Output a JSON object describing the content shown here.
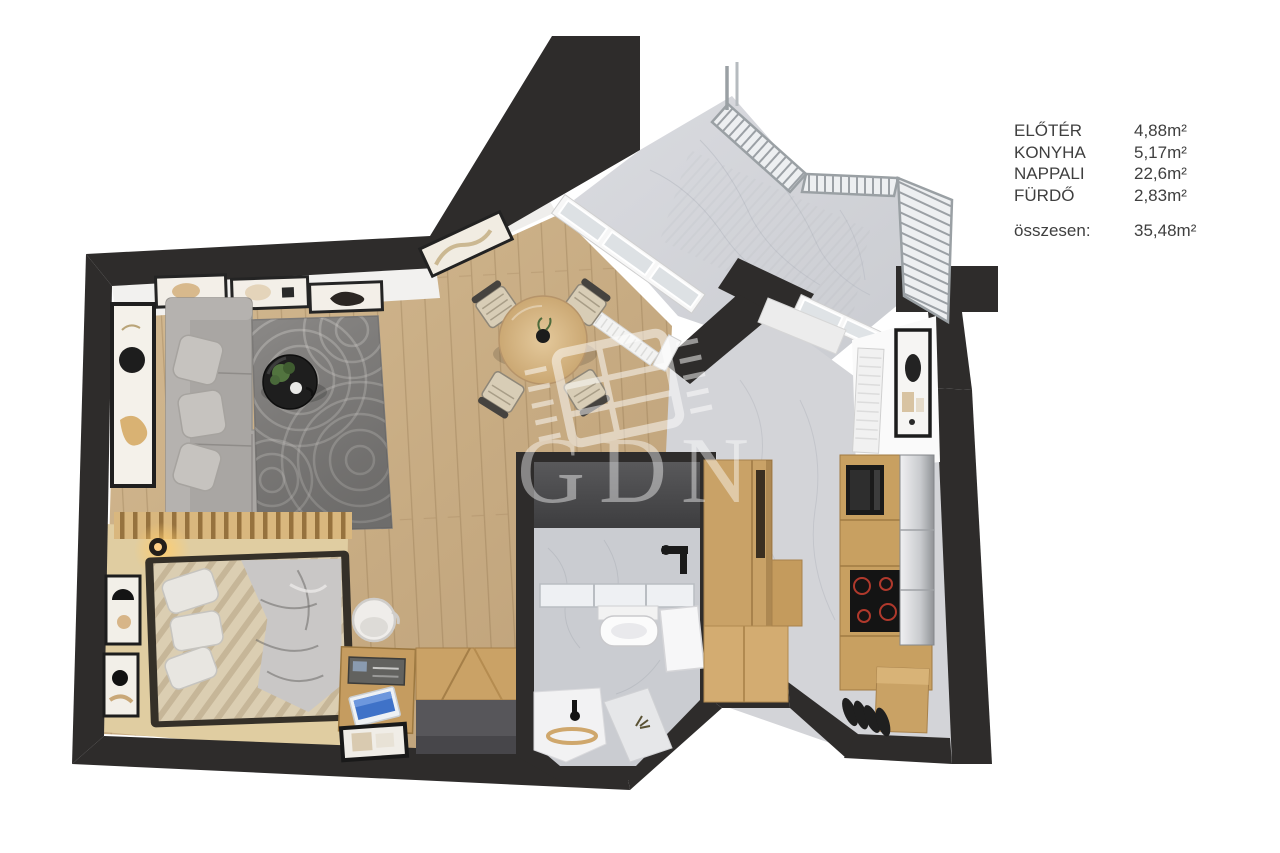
{
  "legend": {
    "rows": [
      {
        "label": "ELŐTÉR",
        "value": "4,88m²"
      },
      {
        "label": "KONYHA",
        "value": "5,17m²"
      },
      {
        "label": "NAPPALI",
        "value": "22,6m²"
      },
      {
        "label": "FÜRDŐ",
        "value": "2,83m²"
      }
    ],
    "total_label": "összesen:",
    "total_value": "35,48m²"
  },
  "watermark": {
    "text": "GDN"
  },
  "floorplan": {
    "type": "apartment-3d-floorplan",
    "colors": {
      "wall": "#2e2c2b",
      "wood_floor": "#c9ad85",
      "bedroom_carpet": "#e0cda1",
      "marble_floor": "#d3d4d8",
      "cooktop_ring_red": "#b0392c",
      "sofa_gray": "#a9a6a3",
      "rug_gray": "#8b8987"
    }
  }
}
